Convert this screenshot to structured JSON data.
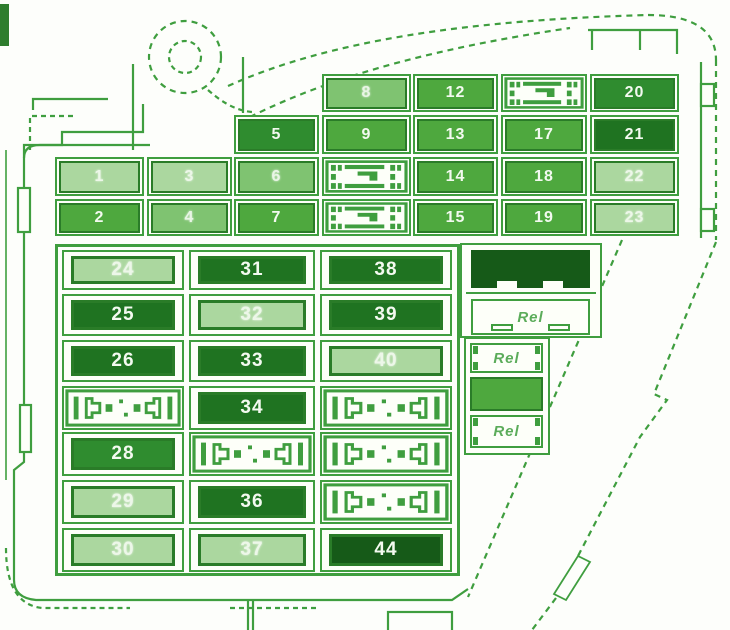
{
  "diagram": {
    "kind": "fuse-box-diagram",
    "relay_label": "Rel"
  },
  "colors": {
    "line": "#3f9e3f",
    "fuse_border": "#2a7c28",
    "number_text": "#f3faf0",
    "shade_light": "#abd79f",
    "shade_light_med": "#7fc371",
    "shade_medium": "#4ea83e",
    "shade_med_dark": "#2f8c2f",
    "shade_dark": "#1f7321",
    "shade_darkest": "#165a18",
    "background": "#fdfefb"
  },
  "top_section": {
    "fuses": [
      {
        "label": "1",
        "col": 0,
        "row": 2,
        "shade": "light"
      },
      {
        "label": "2",
        "col": 0,
        "row": 3,
        "shade": "medium"
      },
      {
        "label": "3",
        "col": 1,
        "row": 2,
        "shade": "light"
      },
      {
        "label": "4",
        "col": 1,
        "row": 3,
        "shade": "light_med"
      },
      {
        "label": "5",
        "col": 2,
        "row": 1,
        "shade": "med_dark"
      },
      {
        "label": "6",
        "col": 2,
        "row": 2,
        "shade": "light_med"
      },
      {
        "label": "7",
        "col": 2,
        "row": 3,
        "shade": "medium"
      },
      {
        "label": "8",
        "col": 3,
        "row": 0,
        "shade": "light_med"
      },
      {
        "label": "9",
        "col": 3,
        "row": 1,
        "shade": "medium"
      },
      {
        "type": "connector",
        "col": 3,
        "row": 2
      },
      {
        "type": "connector",
        "col": 3,
        "row": 3
      },
      {
        "label": "12",
        "col": 4,
        "row": 0,
        "shade": "medium"
      },
      {
        "label": "13",
        "col": 4,
        "row": 1,
        "shade": "medium"
      },
      {
        "label": "14",
        "col": 4,
        "row": 2,
        "shade": "medium"
      },
      {
        "label": "15",
        "col": 4,
        "row": 3,
        "shade": "medium"
      },
      {
        "type": "connector",
        "col": 5,
        "row": 0
      },
      {
        "label": "17",
        "col": 5,
        "row": 1,
        "shade": "medium"
      },
      {
        "label": "18",
        "col": 5,
        "row": 2,
        "shade": "medium"
      },
      {
        "label": "19",
        "col": 5,
        "row": 3,
        "shade": "medium"
      },
      {
        "label": "20",
        "col": 6,
        "row": 0,
        "shade": "med_dark"
      },
      {
        "label": "21",
        "col": 6,
        "row": 1,
        "shade": "dark"
      },
      {
        "label": "22",
        "col": 6,
        "row": 2,
        "shade": "light"
      },
      {
        "label": "23",
        "col": 6,
        "row": 3,
        "shade": "light"
      }
    ]
  },
  "bottom_section": {
    "fuses": [
      {
        "label": "24",
        "col": 0,
        "row": 0,
        "shade": "light"
      },
      {
        "label": "25",
        "col": 0,
        "row": 1,
        "shade": "dark"
      },
      {
        "label": "26",
        "col": 0,
        "row": 2,
        "shade": "dark"
      },
      {
        "type": "relay",
        "col": 0,
        "row": 3
      },
      {
        "label": "28",
        "col": 0,
        "row": 4,
        "shade": "med_dark"
      },
      {
        "label": "29",
        "col": 0,
        "row": 5,
        "shade": "light"
      },
      {
        "label": "30",
        "col": 0,
        "row": 6,
        "shade": "light"
      },
      {
        "label": "31",
        "col": 1,
        "row": 0,
        "shade": "dark"
      },
      {
        "label": "32",
        "col": 1,
        "row": 1,
        "shade": "light"
      },
      {
        "label": "33",
        "col": 1,
        "row": 2,
        "shade": "dark"
      },
      {
        "label": "34",
        "col": 1,
        "row": 3,
        "shade": "dark"
      },
      {
        "type": "relay",
        "col": 1,
        "row": 4
      },
      {
        "label": "36",
        "col": 1,
        "row": 5,
        "shade": "dark"
      },
      {
        "label": "37",
        "col": 1,
        "row": 6,
        "shade": "light"
      },
      {
        "label": "38",
        "col": 2,
        "row": 0,
        "shade": "dark"
      },
      {
        "label": "39",
        "col": 2,
        "row": 1,
        "shade": "dark"
      },
      {
        "label": "40",
        "col": 2,
        "row": 2,
        "shade": "light"
      },
      {
        "type": "relay",
        "col": 2,
        "row": 3
      },
      {
        "type": "relay",
        "col": 2,
        "row": 4
      },
      {
        "type": "relay",
        "col": 2,
        "row": 5
      },
      {
        "label": "44",
        "col": 2,
        "row": 6,
        "shade": "darkest"
      }
    ]
  },
  "relay_panel": {
    "wide_boxes": [
      {
        "type": "solid_dark"
      },
      {
        "type": "rel",
        "label": "Rel"
      }
    ],
    "narrow_boxes": [
      {
        "type": "rel_rail",
        "label": "Rel"
      },
      {
        "type": "solid_medium"
      },
      {
        "type": "rel_rail",
        "label": "Rel"
      }
    ]
  }
}
